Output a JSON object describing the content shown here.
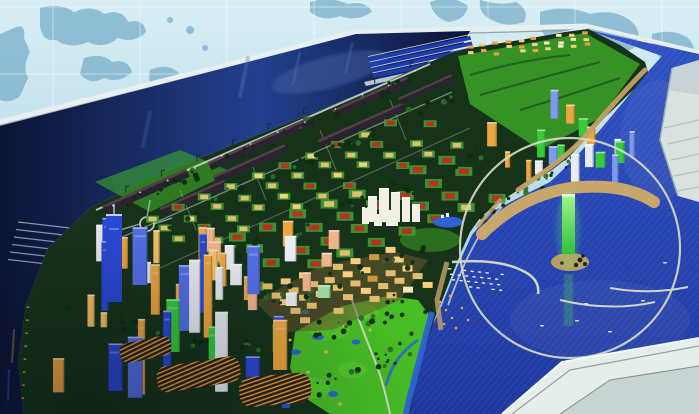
{
  "meta": {
    "title": "Coastal city master-plan scale model",
    "media_type": "photograph",
    "description": "Aerial view of an illuminated architectural scale model of a waterfront city master plan, photographed against a light blue world-map backdrop wall. A dark navy harbor basin with container docks and long quay warehouses runs along the upper left; gridded tan industrial blocks and red-roofed villa rows fill the center; a glowing blue-and-amber high-rise downtown sits at the lower left; a bright green golf course lies bottom center; and on the right a circular lagoon with a glowing green observation tower, a marina full of white boats and curved breakwaters opens to a deep blue sea, framed by the white display-table edge.",
    "seed": 20240612
  },
  "palette": {
    "wallTop": "#d8eef4",
    "wallBot": "#96c6dc",
    "continent": "#84b6ce",
    "wallGrid": "#ffffff",
    "edgeLight": "#e7eff1",
    "edgeShade": "#8fa0aa",
    "faceGray": "#a9bac4",
    "navyDeep": "#0b1434",
    "navyMid": "#23408e",
    "navyLight": "#44609f",
    "dockNavy": "#1d3cae",
    "seaTop": "#3052c4",
    "seaBot": "#1e38a0",
    "lagoonRing": "#d8dec6",
    "causeway": "#c8a76c",
    "beach": "#c4a168",
    "frameWhite": "#e6edeb",
    "frameMid": "#c7d4d2",
    "frameSeam": "#7e9090",
    "slabWhite": "#d9e2de",
    "slabShade": "#b6c2be",
    "landDark": "#16331a",
    "landGreen": "#2d6e2b",
    "brightGreen": "#3faa28",
    "golfGreen": "#47bd25",
    "treeDark": "#0e2b12",
    "roadLight": "#c9d0d3",
    "warehouse": "#2b2430",
    "warehouseTop": "#544048",
    "villaGreen": "#3f9c35",
    "redRoof": "#b5331f",
    "tanRoof": "#e5bd6e",
    "goldLit": "#f7cf7e",
    "orangeLit": "#f2a03d",
    "amberDeep": "#cf9a3e",
    "cream": "#f3e6b8",
    "towerBlue": "#2b49d6",
    "towerBlueLight": "#5570e8",
    "towerGreen": "#35cc3c",
    "towerWhite": "#e9edf2",
    "towerAmber": "#eda63f",
    "amberLight": "#f6c468",
    "towerPeach": "#f0b58a",
    "mintGreen": "#9fdca8",
    "periBlue": "#7d9af0",
    "glowGreen1": "#a4f58b",
    "glowGreen2": "#2fbf3a",
    "reflectGreen": "#4ae04e",
    "pondBlue": "#2f62d6",
    "boatWhite": "#e8eef2",
    "lightWarm": "#ffeec2",
    "stripeDark": "#2a2113",
    "stripeOrange": "#f0a840",
    "craneDark": "#23282e",
    "pier": "#9db1c4"
  },
  "scene": {
    "regions": [
      {
        "name": "map-wall",
        "label": "World map backdrop wall with grid lines"
      },
      {
        "name": "table-edge",
        "label": "Light gray far edge of the model table"
      },
      {
        "name": "harbor-basin",
        "label": "Dark navy harbor water with piers"
      },
      {
        "name": "container-docks",
        "label": "Parallel blue dock berths at the far edge"
      },
      {
        "name": "quay-warehouses",
        "label": "Long dark warehouse sheds with cranes along the quay"
      },
      {
        "name": "industrial-district",
        "label": "Grid of tan and red roofed industrial blocks"
      },
      {
        "name": "villa-district",
        "label": "Grid of red-roofed villas on green plots"
      },
      {
        "name": "central-white-towers",
        "label": "Cluster of white towers with pond"
      },
      {
        "name": "gold-lowrise-district",
        "label": "Golden illuminated low-rise quarter"
      },
      {
        "name": "downtown-cbd",
        "label": "Illuminated blue, amber and green skyscraper downtown"
      },
      {
        "name": "golf-course",
        "label": "Bright green golf course with ponds and river"
      },
      {
        "name": "lagoon",
        "label": "Circular lagoon with glowing green observation tower"
      },
      {
        "name": "marina",
        "label": "Marina with rows of white boats"
      },
      {
        "name": "breakwaters",
        "label": "Curved breakwater arms in the sea"
      },
      {
        "name": "sea",
        "label": "Deep blue model sea"
      },
      {
        "name": "display-frame",
        "label": "White display table corner frame"
      },
      {
        "name": "foreground-structure",
        "label": "White structure at right edge"
      }
    ]
  },
  "generators": {
    "grids": [
      {
        "name": "industrial-grid",
        "origin": [
          152,
          218
        ],
        "colStep": [
          26.5,
          -10.5
        ],
        "rowStep": [
          13,
          10.5
        ],
        "cols": 11,
        "rows": 4,
        "pad": {
          "w": 13,
          "h": 7,
          "color": "villaGreen"
        },
        "roof": {
          "w": 8,
          "h": 4.5
        },
        "roofColors": [
          [
            "tanRoof",
            5
          ],
          [
            "goldLit",
            2
          ],
          [
            "redRoof",
            3
          ]
        ],
        "skip": 0.15
      },
      {
        "name": "villa-grid",
        "origin": [
          208,
          248
        ],
        "colStep": [
          30,
          -11
        ],
        "rowStep": [
          16,
          12.5
        ],
        "cols": 9,
        "rows": 4,
        "pad": {
          "w": 17,
          "h": 9,
          "color": "villaGreen"
        },
        "roof": {
          "w": 10,
          "h": 5.5
        },
        "roofColors": [
          [
            "redRoof",
            8
          ],
          [
            "tanRoof",
            2
          ]
        ],
        "skip": 0.12
      },
      {
        "name": "gold-lowrise-grid",
        "origin": [
          268,
          286
        ],
        "colStep": [
          17.5,
          -5
        ],
        "rowStep": [
          9,
          8.5
        ],
        "cols": 8,
        "rows": 5,
        "pad": null,
        "roof": {
          "w": 10,
          "h": 6
        },
        "roofColors": [
          [
            "tanRoof",
            4
          ],
          [
            "goldLit",
            3
          ],
          [
            "amberDeep",
            2
          ],
          [
            "cream",
            1
          ]
        ],
        "skip": 0.18
      },
      {
        "name": "far-lit-rows",
        "origin": [
          470,
          46
        ],
        "colStep": [
          12.8,
          -1.4
        ],
        "rowStep": [
          1,
          5.5
        ],
        "cols": 10,
        "rows": 3,
        "pad": null,
        "roof": {
          "w": 5.5,
          "h": 3
        },
        "roofColors": [
          [
            "orangeLit",
            6
          ],
          [
            "goldLit",
            3
          ],
          [
            "cream",
            1
          ]
        ],
        "skip": 0.2
      }
    ],
    "towerClusters": [
      {
        "name": "left-cbd-towers",
        "region": [
          30,
          285,
          275,
          400
        ],
        "count": 22,
        "w": [
          7,
          15
        ],
        "h": [
          22,
          85
        ],
        "colors": [
          [
            "towerBlue",
            8
          ],
          [
            "towerBlueLight",
            3
          ],
          [
            "towerAmber",
            4
          ],
          [
            "towerGreen",
            3
          ],
          [
            "towerWhite",
            3
          ]
        ]
      },
      {
        "name": "waterfront-amber-towers",
        "region": [
          85,
          255,
          235,
          330
        ],
        "count": 12,
        "w": [
          6,
          10
        ],
        "h": [
          14,
          38
        ],
        "colors": [
          [
            "towerAmber",
            6
          ],
          [
            "amberLight",
            3
          ],
          [
            "towerWhite",
            2
          ]
        ]
      },
      {
        "name": "midrise-cluster",
        "region": [
          200,
          245,
          330,
          318
        ],
        "count": 14,
        "w": [
          8,
          14
        ],
        "h": [
          12,
          26
        ],
        "colors": [
          [
            "towerPeach",
            4
          ],
          [
            "mintGreen",
            2
          ],
          [
            "towerWhite",
            3
          ],
          [
            "towerAmber",
            2
          ]
        ]
      },
      {
        "name": "right-cbd-towers",
        "region": [
          487,
          118,
          652,
          185
        ],
        "count": 18,
        "w": [
          5,
          10
        ],
        "h": [
          10,
          30
        ],
        "colors": [
          [
            "towerGreen",
            5
          ],
          [
            "towerWhite",
            4
          ],
          [
            "periBlue",
            3
          ],
          [
            "towerAmber",
            2
          ]
        ]
      }
    ],
    "treeBelts": [
      {
        "name": "shore-tree-belt",
        "from": [
          100,
          215
        ],
        "to": [
          432,
          70
        ],
        "count": 40,
        "spread": 5
      },
      {
        "name": "avenue-tree-belt",
        "from": [
          125,
          242
        ],
        "to": [
          455,
          95
        ],
        "count": 34,
        "spread": 6
      },
      {
        "name": "villa-tree-belt",
        "from": [
          210,
          262
        ],
        "to": [
          500,
          150
        ],
        "count": 30,
        "spread": 9
      },
      {
        "name": "gold-tree-belt",
        "from": [
          255,
          305
        ],
        "to": [
          420,
          255
        ],
        "count": 26,
        "spread": 10
      },
      {
        "name": "coast-tree-belt",
        "from": [
          600,
          132
        ],
        "to": [
          478,
          228
        ],
        "count": 26,
        "spread": 7
      },
      {
        "name": "golf-tree-belt",
        "from": [
          300,
          335
        ],
        "to": [
          420,
          300
        ],
        "count": 22,
        "spread": 12
      },
      {
        "name": "golf-tree-belt-2",
        "from": [
          305,
          395
        ],
        "to": [
          420,
          340
        ],
        "count": 20,
        "spread": 10
      },
      {
        "name": "cbd-tree-belt",
        "from": [
          60,
          300
        ],
        "to": [
          270,
          360
        ],
        "count": 24,
        "spread": 14
      }
    ],
    "boats": {
      "marina": {
        "start": [
          448,
          268
        ],
        "colStep": [
          7.5,
          0.8
        ],
        "rowStep": [
          2,
          5.5
        ],
        "cols": 8,
        "rows": 4
      },
      "sea": [
        [
          540,
          325
        ],
        [
          575,
          320
        ],
        [
          608,
          331
        ],
        [
          584,
          303
        ],
        [
          641,
          300
        ],
        [
          663,
          262
        ]
      ]
    },
    "piers": {
      "count": 6,
      "start": [
        70,
        228
      ],
      "dx": -52,
      "dy": -6,
      "stepY": 7.5
    },
    "cranes": {
      "line": [
        [
          108,
          200
        ],
        [
          428,
          60
        ]
      ],
      "count": 9
    },
    "quayLights": {
      "line": [
        [
          100,
          212
        ],
        [
          430,
          66
        ]
      ],
      "count": 12
    },
    "shoreLights": {
      "line": [
        [
          27,
          300
        ],
        [
          21,
          404
        ]
      ],
      "count": 8
    }
  }
}
